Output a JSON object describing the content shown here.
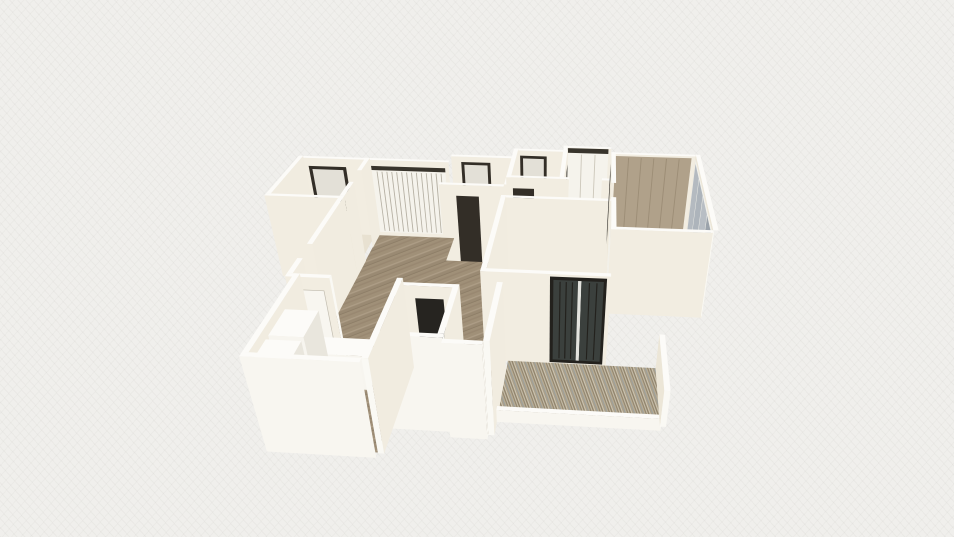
{
  "canvas": {
    "width": 954,
    "height": 537,
    "background": "#f0efec"
  },
  "palette": {
    "topFace": "#fcfbf8",
    "southFace": "#f2ede1",
    "eastFace": "#f1ece0",
    "westFace": "#ece6d7",
    "capFace": "#faf9f4",
    "brightSouth": "#f8f6f0",
    "whiteFloor": "#f1efe9",
    "creamFloor": "#e8e1d1",
    "wood": "url(#woodPat)",
    "slats": "url(#slatPat)",
    "dark": "#332e27",
    "dark2": "#262420",
    "paneLight": "#e3e0d7",
    "railDark": "#38342c",
    "panelWhite": "#f5f3ec",
    "divGray": "#ccc7ba",
    "stripeGray": "#b5b0a3",
    "tan": "#b0a18a",
    "tanStripe": "#9c8d76",
    "glassFrame": "#f1f0ea",
    "glassA": "#b4bac0",
    "glassB": "#adb4bb",
    "glassC": "#b8bec4",
    "glassD": "#9ba3ab",
    "sliderFrame": "#23211d",
    "sliderDark": "#3b403d",
    "mullLight": "#e4e4df",
    "doorLeaf": "#f8f6f0",
    "leafStroke": "#c2bdb0",
    "boxFront": "#f7f5ef",
    "boxSide": "#e9e6dd"
  },
  "scene": {
    "camera": {
      "pos": [
        8.1,
        19.56,
        10.53
      ],
      "fwd": [
        -0.0642,
        -0.828,
        -0.5567
      ],
      "right": [
        0.997,
        -0.0773,
        0
      ],
      "up": [
        -0.043,
        -0.555,
        0.8305
      ],
      "f": 742,
      "cx": 543,
      "cy": 292
    },
    "wallH": 2.35,
    "wallT": 0.12,
    "items": [
      {
        "t": "we",
        "n": "room-e-north-wall",
        "x1": 7.17,
        "x2": 8.5,
        "y": 0
      },
      {
        "t": "qy",
        "n": "room-e-closet-doors",
        "x1": 7.28,
        "x2": 8.42,
        "y": 0.135,
        "z1": 0.1,
        "z2": 2.2,
        "fill": "panelWhite",
        "stripes": 2,
        "fill2": "divGray"
      },
      {
        "t": "qy",
        "n": "room-e-closet-rail",
        "x1": 7.28,
        "x2": 8.42,
        "y": 0.135,
        "z1": 2.2,
        "z2": 2.34,
        "fill": "railDark",
        "inter": "false"
      },
      {
        "t": "we",
        "n": "bath-d-north-wall",
        "x1": 5.8,
        "x2": 7.17,
        "y": 0.3
      },
      {
        "t": "qy",
        "n": "bath-d-window-frame",
        "x1": 5.98,
        "x2": 6.72,
        "y": 0.435,
        "z1": 1.0,
        "z2": 2.2,
        "fill": "dark"
      },
      {
        "t": "qy",
        "n": "bath-d-window-pane",
        "x1": 6.06,
        "x2": 6.64,
        "y": 0.435,
        "z1": 1.08,
        "z2": 2.12,
        "fill": "paneLight",
        "inter": "false"
      },
      {
        "t": "wn",
        "n": "room-e-west-wall",
        "x": 7.17,
        "y1": 0,
        "y2": 2.05
      },
      {
        "t": "qx",
        "n": "room-e-side-door",
        "x": 7.302,
        "y1": 0.45,
        "y2": 1.0,
        "z1": 0,
        "z2": 2.0,
        "fill": "dark2"
      },
      {
        "t": "f",
        "n": "room-e-floor",
        "x1": 7.29,
        "y1": 0.12,
        "x2": 8.5,
        "y2": 2.05,
        "fill": "whiteFloor"
      },
      {
        "t": "f",
        "n": "bath-d-floor",
        "x1": 5.92,
        "y1": 0.42,
        "x2": 7.17,
        "y2": 2.05,
        "fill": "whiteFloor"
      },
      {
        "t": "we",
        "n": "bath-c-north-wall",
        "x1": 4.15,
        "x2": 5.8,
        "y": 0.85
      },
      {
        "t": "qy",
        "n": "bath-c-window-frame",
        "x1": 4.42,
        "x2": 5.22,
        "y": 0.985,
        "z1": 1.0,
        "z2": 2.2,
        "fill": "dark"
      },
      {
        "t": "qy",
        "n": "bath-c-window-pane",
        "x1": 4.5,
        "x2": 5.14,
        "y": 0.985,
        "z1": 1.08,
        "z2": 2.12,
        "fill": "paneLight",
        "inter": "false"
      },
      {
        "t": "wn",
        "n": "bath-divider-wall",
        "x": 5.8,
        "y1": 0.3,
        "y2": 2.6
      },
      {
        "t": "f",
        "n": "bath-c-floor",
        "x1": 4.27,
        "y1": 0.97,
        "x2": 5.8,
        "y2": 2.6,
        "fill": "whiteFloor"
      },
      {
        "t": "we",
        "n": "entry-north-wall",
        "x1": 0,
        "x2": 4.15,
        "y": 1.25
      },
      {
        "t": "qy",
        "n": "entry-window-frame",
        "x1": 0.28,
        "x2": 1.32,
        "y": 1.385,
        "z1": 0.78,
        "z2": 2.12,
        "fill": "dark"
      },
      {
        "t": "qy",
        "n": "entry-window-pane",
        "x1": 0.37,
        "x2": 1.23,
        "y": 1.385,
        "z1": 1.12,
        "z2": 2.03,
        "fill": "paneLight",
        "inter": "false"
      },
      {
        "t": "qy",
        "n": "entry-window-sill",
        "x1": 0.37,
        "x2": 1.23,
        "y": 1.385,
        "z1": 0.87,
        "z2": 1.12,
        "fill": "railDark",
        "inter": "false"
      },
      {
        "t": "qy",
        "n": "hall-wardrobe",
        "x1": 2.02,
        "x2": 4.05,
        "y": 1.385,
        "z1": 0.14,
        "z2": 2.06,
        "fill": "panelWhite",
        "stripes": 14,
        "fill2": "stripeGray"
      },
      {
        "t": "qy",
        "n": "hall-wardrobe-rail",
        "x1": 2.02,
        "x2": 4.05,
        "y": 1.385,
        "z1": 2.06,
        "z2": 2.18,
        "fill": "railDark",
        "inter": "false"
      },
      {
        "t": "wn",
        "n": "entry-west-wall",
        "x": 0,
        "y1": 1.25,
        "y2": 3.55
      },
      {
        "t": "f",
        "n": "entry-floor",
        "x1": 0.12,
        "y1": 1.37,
        "x2": 1.85,
        "y2": 3.55,
        "fill": "creamFloor"
      },
      {
        "t": "f",
        "n": "bedroom-right-floor",
        "x1": 8.62,
        "y1": 0.47,
        "x2": 10.8,
        "y2": 4.6,
        "fill": "wood"
      },
      {
        "t": "we",
        "n": "bedroom-right-north-wall",
        "x1": 8.5,
        "x2": 10.8,
        "y": 0.35
      },
      {
        "t": "qy",
        "n": "bedroom-right-closet",
        "x1": 8.62,
        "x2": 10.68,
        "y": 0.485,
        "z1": 0.06,
        "z2": 2.3,
        "fill": "tan",
        "stripes": 5,
        "fill2": "tanStripe"
      },
      {
        "t": "wn",
        "n": "bedroom-right-window-wall",
        "x": 10.8,
        "y1": 0.35,
        "y2": 4.6
      },
      {
        "t": "qx",
        "n": "bedroom-right-glass-frame",
        "x": 10.79,
        "y1": 0.5,
        "y2": 4.5,
        "z1": 0.05,
        "z2": 2.28,
        "fill": "glassFrame",
        "inter": "false"
      },
      {
        "t": "qx",
        "n": "glass-pane",
        "x": 10.785,
        "y1": 0.62,
        "y2": 1.55,
        "z1": 0.14,
        "z2": 2.2,
        "fill": "glassA"
      },
      {
        "t": "qx",
        "n": "glass-pane",
        "x": 10.785,
        "y1": 1.62,
        "y2": 2.55,
        "z1": 0.14,
        "z2": 2.2,
        "fill": "glassB"
      },
      {
        "t": "qx",
        "n": "glass-pane",
        "x": 10.785,
        "y1": 2.62,
        "y2": 3.55,
        "z1": 0.14,
        "z2": 2.2,
        "fill": "glassC"
      },
      {
        "t": "qx",
        "n": "glass-pane",
        "x": 10.785,
        "y1": 3.62,
        "y2": 4.42,
        "z1": 0.14,
        "z2": 2.2,
        "fill": "glassD"
      },
      {
        "t": "f",
        "n": "anteroom-floor",
        "x1": 5.92,
        "y1": 2.05,
        "x2": 8.5,
        "y2": 3.2,
        "fill": "wood"
      },
      {
        "t": "we",
        "n": "bath-d-south-wall",
        "x1": 5.8,
        "x2": 7.17,
        "y": 2.05
      },
      {
        "t": "qy",
        "n": "bath-d-door",
        "x1": 5.97,
        "x2": 6.52,
        "y": 2.185,
        "z1": 0,
        "z2": 2.05,
        "fill": "dark"
      },
      {
        "t": "we",
        "n": "room-e-south-wall-west",
        "x1": 7.17,
        "x2": 7.42,
        "y": 2.05,
        "cap": true
      },
      {
        "t": "we",
        "n": "room-e-south-wall-east",
        "x1": 8.26,
        "x2": 8.5,
        "y": 2.05
      },
      {
        "t": "we",
        "n": "bath-c-south-wall",
        "x1": 4.15,
        "x2": 5.8,
        "y": 2.6
      },
      {
        "t": "qy",
        "n": "bath-c-door",
        "x1": 4.58,
        "x2": 5.16,
        "y": 2.735,
        "z1": 0,
        "z2": 2.05,
        "fill": "dark"
      },
      {
        "t": "f",
        "n": "hallway-floor",
        "pts": [
          [
            1.97,
            1.37
          ],
          [
            4.15,
            1.37
          ],
          [
            4.15,
            2.6
          ],
          [
            5.92,
            2.6
          ],
          [
            5.92,
            7.1
          ],
          [
            1.97,
            7.1
          ]
        ],
        "fill": "wood"
      },
      {
        "t": "wn",
        "n": "entry-east-wall-north",
        "x": 1.85,
        "y1": 1.25,
        "y2": 2.05
      },
      {
        "t": "wn",
        "n": "entry-east-wall-south",
        "x": 1.85,
        "y1": 2.75,
        "y2": 3.55
      },
      {
        "t": "we",
        "n": "entry-south-wall",
        "x1": 0,
        "x2": 1.85,
        "y": 3.55,
        "cap": true
      },
      {
        "t": "we",
        "n": "bedroom-mid-north-wall",
        "x1": 5.8,
        "x2": 8.5,
        "y": 3.2
      },
      {
        "t": "wn",
        "n": "bedroom-mid-west-wall",
        "x": 5.8,
        "y1": 3.2,
        "y2": 6.72
      },
      {
        "t": "f",
        "n": "bedroom-mid-floor",
        "x1": 5.92,
        "y1": 3.32,
        "x2": 8.5,
        "y2": 6.6,
        "fill": "wood"
      },
      {
        "t": "wn",
        "n": "bedroom-divider-wall-north",
        "x": 8.5,
        "y1": 0.35,
        "y2": 2.3
      },
      {
        "t": "qx",
        "n": "bedroom-right-door",
        "x": 8.49,
        "y1": 0.55,
        "y2": 1.35,
        "z1": 0,
        "z2": 2.1,
        "fill": "dark2"
      },
      {
        "t": "wn",
        "n": "bedroom-divider-wall-south",
        "x": 8.5,
        "y1": 3.1,
        "y2": 6.6
      },
      {
        "t": "qx",
        "n": "bedroom-mid-wardrobe",
        "x": 8.49,
        "y1": 3.35,
        "y2": 5.15,
        "z1": 0.05,
        "z2": 2.25,
        "fill": "panelWhite",
        "stripes": 3,
        "fill2": "divGray"
      },
      {
        "t": "we",
        "n": "bedroom-right-south-wall",
        "x1": 8.5,
        "x2": 10.8,
        "y": 4.6,
        "cap": true
      },
      {
        "t": "we",
        "n": "bedroom-mid-south-wall",
        "x1": 5.8,
        "x2": 8.5,
        "y": 6.6
      },
      {
        "t": "qy",
        "n": "balcony-slider-frame",
        "x1": 7.25,
        "x2": 8.42,
        "y": 6.735,
        "z1": 0.04,
        "z2": 2.3,
        "fill": "sliderFrame"
      },
      {
        "t": "qy",
        "n": "balcony-slider-glass",
        "x1": 7.32,
        "x2": 7.83,
        "y": 6.736,
        "z1": 0.12,
        "z2": 2.22,
        "fill": "sliderDark",
        "stripes": 3,
        "fill2": "sliderFrame"
      },
      {
        "t": "qy",
        "n": "slider-mullion",
        "x1": 7.83,
        "x2": 7.9,
        "y": 6.737,
        "z1": 0.12,
        "z2": 2.22,
        "fill": "mullLight",
        "inter": "false"
      },
      {
        "t": "qy",
        "n": "balcony-slider-glass",
        "x1": 7.9,
        "x2": 8.36,
        "y": 6.736,
        "z1": 0.12,
        "z2": 2.22,
        "fill": "sliderDark",
        "stripes": 2,
        "fill2": "sliderFrame"
      },
      {
        "t": "wn",
        "n": "hall-west-wall-north",
        "x": 1.85,
        "y1": 3.55,
        "y2": 5.9
      },
      {
        "t": "wn",
        "n": "hall-west-wall-south",
        "x": 1.85,
        "y1": 6.5,
        "y2": 7.1
      },
      {
        "t": "we",
        "n": "kitchen-north-wall",
        "x1": 1.85,
        "x2": 2.78,
        "y": 7.1,
        "cap": true
      },
      {
        "t": "qy",
        "n": "kitchen-door",
        "x1": 2.04,
        "x2": 2.62,
        "y": 7.235,
        "z1": 0,
        "z2": 2.04,
        "fill": "doorLeaf",
        "stroke": "leafStroke"
      },
      {
        "t": "f",
        "n": "living-extension-floor",
        "x1": 5.46,
        "y1": 7.1,
        "x2": 6.2,
        "y2": 9.05,
        "fill": "wood"
      },
      {
        "t": "we",
        "n": "wc-north-wall",
        "x1": 4.15,
        "x2": 5.46,
        "y": 7.25
      },
      {
        "t": "qy",
        "n": "wc-door",
        "x1": 4.56,
        "x2": 5.14,
        "y": 7.385,
        "z1": 0,
        "z2": 2.06,
        "fill": "dark2"
      },
      {
        "t": "f",
        "n": "wc-floor",
        "x1": 4.27,
        "y1": 7.37,
        "x2": 5.34,
        "y2": 8.9,
        "fill": "whiteFloor"
      },
      {
        "t": "wn",
        "n": "wc-east-wall",
        "x": 5.34,
        "y1": 7.25,
        "y2": 8.9
      },
      {
        "t": "we",
        "n": "wc-south-wall",
        "x1": 4.15,
        "x2": 5.46,
        "y": 8.9,
        "cap": true,
        "fc": "brightSouth"
      },
      {
        "t": "wn",
        "n": "kitchen-west-wall",
        "x": 2.0,
        "y1": 7.1,
        "y2": 9.7
      },
      {
        "t": "f",
        "n": "kitchen-floor",
        "x1": 2.0,
        "y1": 7.22,
        "x2": 4.15,
        "y2": 9.7,
        "fill": "wood"
      },
      {
        "t": "box",
        "n": "kitchen-counter",
        "x1": 2.1,
        "x2": 3.5,
        "y1": 7.35,
        "y2": 7.92,
        "h": 0.92
      },
      {
        "t": "box",
        "n": "kitchen-cabinet",
        "x1": 2.1,
        "x2": 2.78,
        "y1": 8.02,
        "y2": 8.88,
        "h": 2.1
      },
      {
        "t": "box",
        "n": "kitchen-cabinet",
        "x1": 2.1,
        "x2": 2.78,
        "y1": 9.0,
        "y2": 9.58,
        "h": 2.1
      },
      {
        "t": "wn",
        "n": "kitchen-east-wall",
        "x": 4.15,
        "y1": 7.1,
        "y2": 9.7,
        "cap": true
      },
      {
        "t": "we",
        "n": "kitchen-south-wall",
        "x1": 2.0,
        "x2": 4.15,
        "y": 9.7,
        "fc": "brightSouth"
      },
      {
        "t": "we",
        "n": "living-extension-south-wall",
        "x1": 5.46,
        "x2": 6.2,
        "y": 9.05,
        "cap": true,
        "fc": "brightSouth"
      },
      {
        "t": "wn",
        "n": "living-extension-east-wall",
        "x": 6.2,
        "y1": 7.1,
        "y2": 9.05,
        "cap": true
      },
      {
        "t": "f",
        "n": "balcony-deck",
        "x1": 6.32,
        "y1": 6.74,
        "x2": 9.6,
        "y2": 8.55,
        "fill": "slats"
      },
      {
        "t": "we",
        "n": "balcony-parapet-south",
        "x1": 6.32,
        "x2": 9.6,
        "y": 8.55,
        "h": 0.32,
        "cap": true,
        "fc": "brightSouth"
      },
      {
        "t": "wn",
        "n": "balcony-parapet-east",
        "x": 9.6,
        "y1": 6.74,
        "y2": 8.55,
        "h": 0.95,
        "cap": true
      }
    ]
  }
}
